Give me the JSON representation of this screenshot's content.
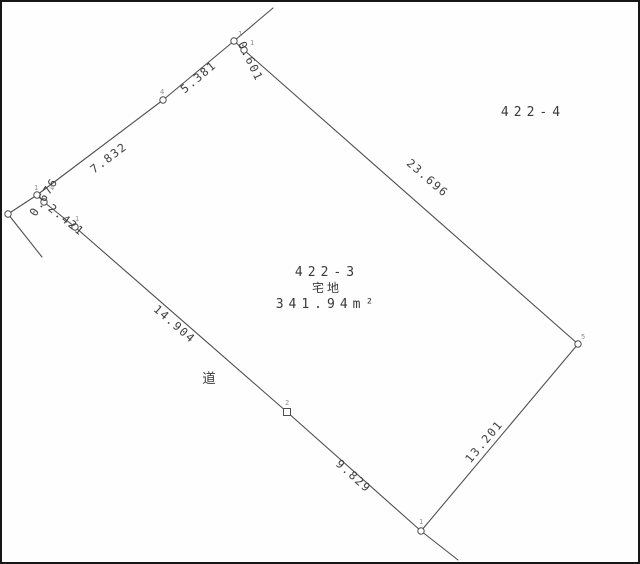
{
  "colors": {
    "background": "#fefefe",
    "frame": "#161616",
    "line": "#4f4f4f",
    "text": "#3d3d3d",
    "point_label": "#8f8f8f"
  },
  "parcel": {
    "number": "422-3",
    "land_category": "宅地",
    "area": "341.94m²"
  },
  "adjacent_parcel": {
    "number": "422-4"
  },
  "road": {
    "label": "道"
  },
  "measurements": {
    "north_upper": "5.381",
    "north_lower": "7.832",
    "west_corner": "0.676",
    "west_upper": "2.421",
    "west_lower": "14.904",
    "south_west": "9.829",
    "south_east": "13.201",
    "east": "23.696",
    "north_corner": "0.601"
  },
  "points": {
    "north_a": "1",
    "north_b": "1",
    "north_mid": "4",
    "west_a": "1",
    "west_b": "4",
    "west_lower": "1",
    "southwest_mid": "2",
    "south": "1",
    "east": "5"
  }
}
